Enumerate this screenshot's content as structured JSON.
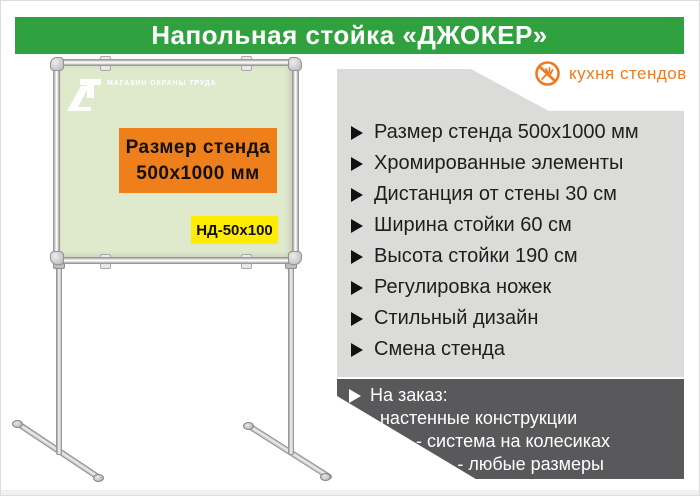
{
  "banner": {
    "title": "Напольная стойка «ДЖОКЕР»",
    "bg": "#2fa23f",
    "text_color": "#ffffff"
  },
  "brand": {
    "name": "кухня стендов",
    "color": "#f0791e",
    "icon": "crossed-fork-icon"
  },
  "stand": {
    "board_bg": "#dfe9cc",
    "board_logo_text": "МАГАЗИН ОХРАНЫ ТРУДА",
    "size_box": {
      "line1": "Размер стенда",
      "line2": "500х1000 мм",
      "bg": "#ef7f1b"
    },
    "model_box": {
      "label": "НД-50х100",
      "bg": "#ffec00"
    }
  },
  "features": {
    "panel_bg": "#dbdbd9",
    "items": [
      "Размер стенда 500х1000 мм",
      "Хромированные элементы",
      "Дистанция от стены 30 см",
      "Ширина стойки 60 см",
      "Высота стойки 190 см",
      "Регулировка ножек",
      "Стильный дизайн",
      "Смена стенда"
    ]
  },
  "custom_order": {
    "bg": "#59595b",
    "title": "На заказ:",
    "items": [
      "- настенные конструкции",
      "- система на колесиках",
      "- любые размеры"
    ]
  }
}
